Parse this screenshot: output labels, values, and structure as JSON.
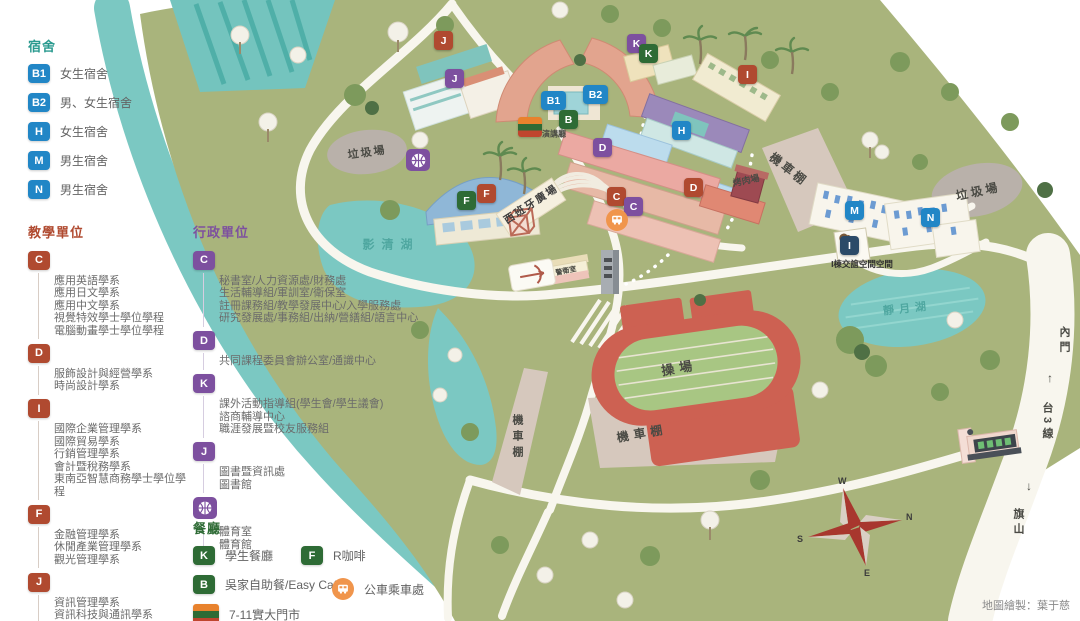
{
  "legend": {
    "dorm": {
      "title": "宿舍",
      "items": [
        {
          "badge": "B1",
          "label": "女生宿舍"
        },
        {
          "badge": "B2",
          "label": "男、女生宿舍"
        },
        {
          "badge": "H",
          "label": "女生宿舍"
        },
        {
          "badge": "M",
          "label": "男生宿舍"
        },
        {
          "badge": "N",
          "label": "男生宿舍"
        }
      ]
    },
    "teaching": {
      "title": "教學單位",
      "groups": [
        {
          "badge": "C",
          "lines": [
            "應用英語學系",
            "應用日文學系",
            "應用中文學系",
            "視覺特效學士學位學程",
            "電腦動畫學士學位學程"
          ]
        },
        {
          "badge": "D",
          "lines": [
            "服飾設計與經營學系",
            "時尚設計學系"
          ]
        },
        {
          "badge": "I",
          "lines": [
            "國際企業管理學系",
            "國際貿易學系",
            "行銷管理學系",
            "會計暨稅務學系",
            "東南亞智慧商務學士學位學程"
          ]
        },
        {
          "badge": "F",
          "lines": [
            "金融管理學系",
            "休閒產業管理學系",
            "觀光管理學系"
          ]
        },
        {
          "badge": "J",
          "lines": [
            "資訊管理學系",
            "資訊科技與通訊學系",
            "資訊模擬與設計學系"
          ]
        }
      ]
    },
    "admin": {
      "title": "行政單位",
      "groups": [
        {
          "badge": "C",
          "lines": [
            "秘書室/人力資源處/財務處",
            "生活輔導組/軍訓室/衛保室",
            "註冊課務組/教學發展中心/入學服務處",
            "研究發展處/事務組/出納/營繕組/語言中心"
          ]
        },
        {
          "badge": "D",
          "lines": [
            "共同課程委員會辦公室/通識中心"
          ]
        },
        {
          "badge": "K",
          "lines": [
            "課外活動指導組(學生會/學生議會)",
            "諮商輔導中心",
            "職涯發展暨校友服務組"
          ]
        },
        {
          "badge": "J",
          "lines": [
            "圖書暨資訊處",
            "圖書館"
          ]
        },
        {
          "badge": "basketball",
          "lines": [
            "體育室",
            "體育館"
          ]
        }
      ]
    },
    "dining": {
      "title": "餐廳",
      "items": [
        {
          "badge": "K",
          "label": "學生餐廳"
        },
        {
          "badge": "F",
          "label": "R咖啡"
        },
        {
          "badge": "B",
          "label": "吳家自助餐/Easy Cafe"
        },
        {
          "badge": "seven-eleven",
          "label": "7-11實大門市"
        },
        {
          "badge": "bus",
          "label": "公車乘車處"
        }
      ]
    }
  },
  "map": {
    "markers": [
      {
        "letter": "J",
        "color": "red"
      },
      {
        "letter": "J",
        "color": "purple"
      },
      {
        "letter": "B1",
        "color": "blue"
      },
      {
        "letter": "B2",
        "color": "blue"
      },
      {
        "letter": "B",
        "color": "green"
      },
      {
        "letter": "K",
        "color": "purple"
      },
      {
        "letter": "K",
        "color": "green"
      },
      {
        "letter": "I",
        "color": "red"
      },
      {
        "letter": "H",
        "color": "blue"
      },
      {
        "letter": "D",
        "color": "purple"
      },
      {
        "letter": "D",
        "color": "red"
      },
      {
        "letter": "C",
        "color": "red"
      },
      {
        "letter": "C",
        "color": "purple"
      },
      {
        "letter": "F",
        "color": "green"
      },
      {
        "letter": "F",
        "color": "red"
      },
      {
        "letter": "M",
        "color": "blue"
      },
      {
        "letter": "N",
        "color": "blue"
      },
      {
        "letter": "I",
        "color": "navy"
      }
    ],
    "labels": [
      {
        "text": "垃圾場"
      },
      {
        "text": "垃圾場"
      },
      {
        "text": "演講廳"
      },
      {
        "text": "西班牙廣場"
      },
      {
        "text": "烤肉場"
      },
      {
        "text": "機車棚"
      },
      {
        "text": "機車棚"
      },
      {
        "text": "機車棚"
      },
      {
        "text": "操場"
      },
      {
        "text": "影清湖"
      },
      {
        "text": "靜月湖"
      },
      {
        "text": "警衛室"
      },
      {
        "text": "I棟交誼空間空間"
      }
    ],
    "road": {
      "north_dest": "內門",
      "up_arrow": "↑",
      "route": "台3線",
      "down_arrow": "↓",
      "south_dest": "旗山"
    },
    "compass": {
      "n": "N",
      "e": "E",
      "s": "S",
      "w": "W"
    },
    "icons": {
      "basketball": "basketball-court",
      "bus": "bus-stop",
      "seven_eleven": "7-11-store",
      "archery": "archery-range"
    }
  },
  "page": {
    "credit": "地圖繪製：葉于慈"
  },
  "colors": {
    "dorm_badge": "#2186c6",
    "teaching_badge": "#b04a30",
    "admin_badge": "#7d509f",
    "dining_badge": "#2e6b35",
    "bus_orange": "#f0954c",
    "water": "#7bc8c2",
    "campus_green": "#a9b47c",
    "track_red": "#cd6152"
  }
}
